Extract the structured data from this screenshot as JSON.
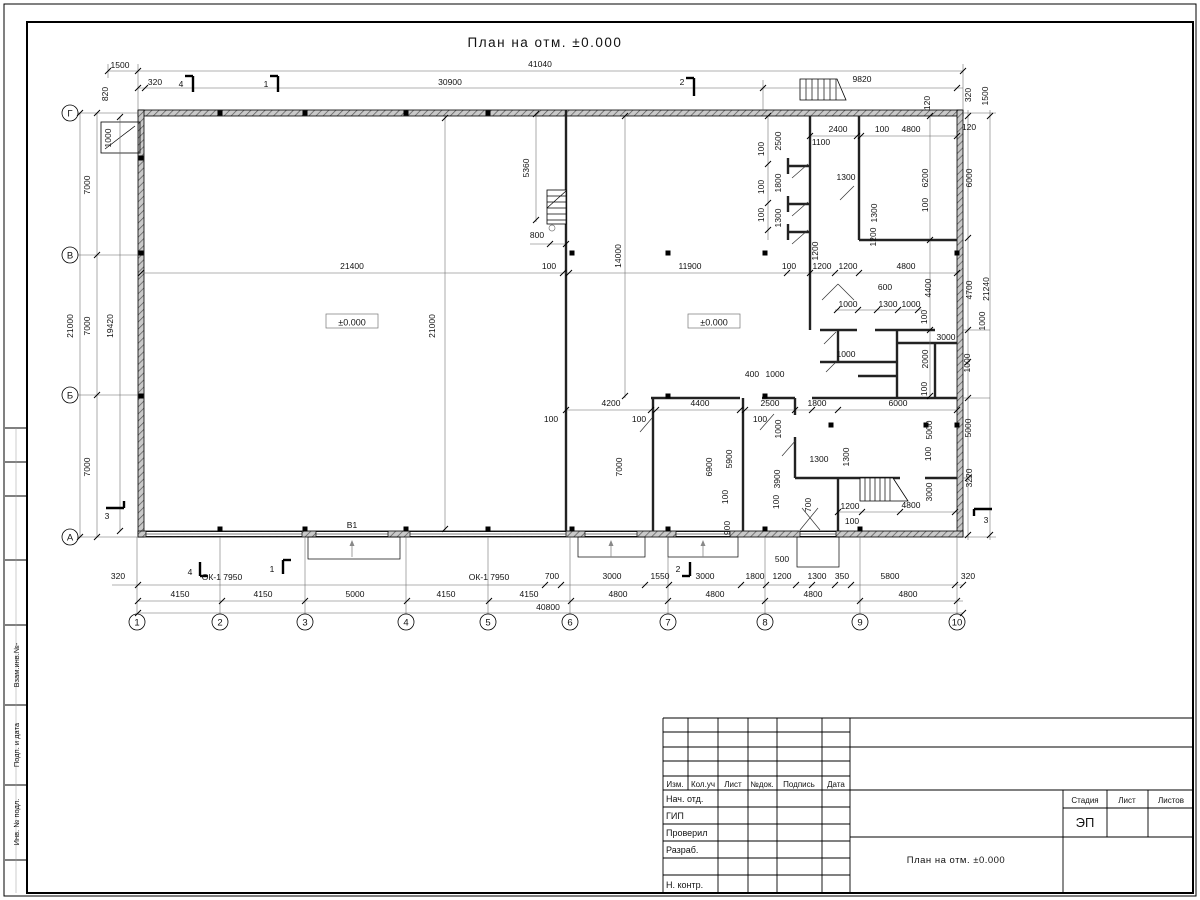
{
  "sheet": {
    "title": "План на отм. ±0.000",
    "frame_labels": [
      "Взам.инв.№-",
      "Подп. и дата",
      "Инв. № подл."
    ],
    "stamp": {
      "header_cols": [
        "Изм.",
        "Кол.уч",
        "Лист",
        "№док.",
        "Подпись",
        "Дата"
      ],
      "rows": [
        "Нач. отд.",
        "ГИП",
        "Проверил",
        "Разраб.",
        "Н. контр."
      ],
      "stage_label": "Стадия",
      "sheet_label": "Лист",
      "sheets_label": "Листов",
      "stage_value": "ЭП",
      "doc_title": "План на отм. ±0.000"
    }
  },
  "plan": {
    "level_mark_text": "±0.000",
    "level_marks": [
      {
        "x": 352,
        "y": 323
      },
      {
        "x": 714,
        "y": 323
      }
    ],
    "axes_bottom": [
      {
        "label": "1",
        "x": 137
      },
      {
        "label": "2",
        "x": 220
      },
      {
        "label": "3",
        "x": 305
      },
      {
        "label": "4",
        "x": 406
      },
      {
        "label": "5",
        "x": 488
      },
      {
        "label": "6",
        "x": 570
      },
      {
        "label": "7",
        "x": 668
      },
      {
        "label": "8",
        "x": 765
      },
      {
        "label": "9",
        "x": 860
      },
      {
        "label": "10",
        "x": 957
      }
    ],
    "axes_left": [
      {
        "label": "Г",
        "y": 113
      },
      {
        "label": "В",
        "y": 255
      },
      {
        "label": "Б",
        "y": 395
      },
      {
        "label": "А",
        "y": 537
      }
    ],
    "dimensions": [
      [
        "1500",
        120,
        68
      ],
      [
        "41040",
        540,
        67
      ],
      [
        "320",
        155,
        85
      ],
      [
        "30900",
        450,
        85
      ],
      [
        "9820",
        862,
        82
      ],
      [
        "4",
        181,
        87
      ],
      [
        "1",
        266,
        87
      ],
      [
        "2",
        682,
        85
      ],
      [
        "820",
        108,
        94,
        1
      ],
      [
        "1000",
        111,
        138,
        1
      ],
      [
        "2400",
        838,
        132
      ],
      [
        "100",
        882,
        132
      ],
      [
        "4800",
        911,
        132
      ],
      [
        "120",
        969,
        130
      ],
      [
        "120",
        930,
        103,
        1
      ],
      [
        "320",
        971,
        95,
        1
      ],
      [
        "1500",
        988,
        96,
        1
      ],
      [
        "7000",
        90,
        185,
        1
      ],
      [
        "7000",
        90,
        326,
        1
      ],
      [
        "7000",
        90,
        467,
        1
      ],
      [
        "21000",
        73,
        326,
        1
      ],
      [
        "19420",
        113,
        326,
        1
      ],
      [
        "6000",
        972,
        178,
        1
      ],
      [
        "4700",
        972,
        290,
        1
      ],
      [
        "21240",
        989,
        289,
        1
      ],
      [
        "1000",
        985,
        321,
        1
      ],
      [
        "1000",
        970,
        363,
        1
      ],
      [
        "5000",
        971,
        428,
        1
      ],
      [
        "3220",
        972,
        478,
        1
      ],
      [
        "21400",
        352,
        269
      ],
      [
        "100",
        549,
        269
      ],
      [
        "11900",
        690,
        269
      ],
      [
        "100",
        789,
        269
      ],
      [
        "1200",
        822,
        269
      ],
      [
        "1200",
        848,
        269
      ],
      [
        "4800",
        906,
        269
      ],
      [
        "14000",
        621,
        256,
        1
      ],
      [
        "21000",
        435,
        326,
        1
      ],
      [
        "5360",
        529,
        168,
        1
      ],
      [
        "800",
        537,
        238
      ],
      [
        "2500",
        781,
        141,
        1
      ],
      [
        "100",
        764,
        149,
        1
      ],
      [
        "1100",
        821,
        145
      ],
      [
        "1800",
        781,
        183,
        1
      ],
      [
        "100",
        764,
        187,
        1
      ],
      [
        "1300",
        781,
        218,
        1
      ],
      [
        "100",
        764,
        215,
        1
      ],
      [
        "1300",
        846,
        180
      ],
      [
        "6200",
        928,
        178,
        1
      ],
      [
        "100",
        928,
        205,
        1
      ],
      [
        "1300",
        877,
        213,
        1
      ],
      [
        "1200",
        876,
        237,
        1
      ],
      [
        "1200",
        818,
        251,
        1
      ],
      [
        "600",
        885,
        290
      ],
      [
        "1000",
        848,
        307
      ],
      [
        "1300",
        888,
        307
      ],
      [
        "1000",
        911,
        307
      ],
      [
        "100",
        927,
        317,
        1
      ],
      [
        "4400",
        931,
        288,
        1
      ],
      [
        "3000",
        946,
        340
      ],
      [
        "2000",
        928,
        359,
        1
      ],
      [
        "1000",
        846,
        357
      ],
      [
        "100",
        927,
        389,
        1
      ],
      [
        "400",
        752,
        377
      ],
      [
        "1000",
        775,
        377
      ],
      [
        "4200",
        611,
        406
      ],
      [
        "100",
        551,
        422
      ],
      [
        "4400",
        700,
        406
      ],
      [
        "100",
        639,
        422
      ],
      [
        "2500",
        770,
        406
      ],
      [
        "1800",
        817,
        406
      ],
      [
        "6000",
        898,
        406
      ],
      [
        "100",
        760,
        422
      ],
      [
        "1000",
        781,
        429,
        1
      ],
      [
        "5000",
        932,
        430,
        1
      ],
      [
        "100",
        931,
        454,
        1
      ],
      [
        "1300",
        819,
        462
      ],
      [
        "1300",
        849,
        457,
        1
      ],
      [
        "3900",
        780,
        479,
        1
      ],
      [
        "100",
        779,
        502,
        1
      ],
      [
        "700",
        811,
        505,
        1
      ],
      [
        "1200",
        850,
        509
      ],
      [
        "100",
        852,
        524
      ],
      [
        "4800",
        911,
        508
      ],
      [
        "3000",
        932,
        492,
        1
      ],
      [
        "7000",
        622,
        467,
        1
      ],
      [
        "6900",
        712,
        467,
        1
      ],
      [
        "5900",
        732,
        459,
        1
      ],
      [
        "100",
        728,
        497,
        1
      ],
      [
        "900",
        730,
        528,
        1
      ],
      [
        "500",
        782,
        562
      ],
      [
        "320",
        118,
        579
      ],
      [
        "4",
        190,
        575
      ],
      [
        "1",
        272,
        572
      ],
      [
        "2",
        678,
        572
      ],
      [
        "3",
        107,
        519
      ],
      [
        "3",
        986,
        523
      ],
      [
        "700",
        552,
        579
      ],
      [
        "3000",
        612,
        579
      ],
      [
        "1550",
        660,
        579
      ],
      [
        "3000",
        705,
        579
      ],
      [
        "1800",
        755,
        579
      ],
      [
        "1200",
        782,
        579
      ],
      [
        "1300",
        817,
        579
      ],
      [
        "350",
        842,
        579
      ],
      [
        "5800",
        890,
        579
      ],
      [
        "320",
        968,
        579
      ],
      [
        "ОК-1 7950",
        222,
        580
      ],
      [
        "ОК-1 7950",
        489,
        580
      ],
      [
        "В1",
        352,
        528
      ],
      [
        "4150",
        180,
        597
      ],
      [
        "4150",
        263,
        597
      ],
      [
        "5000",
        355,
        597
      ],
      [
        "4150",
        446,
        597
      ],
      [
        "4150",
        529,
        597
      ],
      [
        "4800",
        618,
        597
      ],
      [
        "4800",
        715,
        597
      ],
      [
        "4800",
        813,
        597
      ],
      [
        "4800",
        908,
        597
      ],
      [
        "40800",
        548,
        610
      ]
    ]
  }
}
